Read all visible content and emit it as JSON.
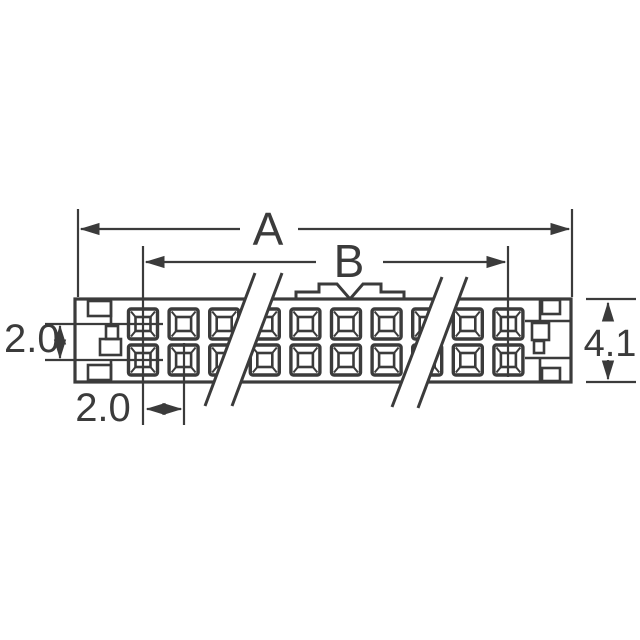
{
  "title": "Connector dimensional drawing",
  "labels": {
    "dim_a": "A",
    "dim_b": "B",
    "row_pitch": "2.0",
    "col_pitch": "2.0",
    "body_height": "4.1"
  },
  "connector": {
    "rows": 2,
    "visible_columns": 10
  },
  "colors": {
    "line": "#3b3b3b",
    "background": "#ffffff"
  }
}
